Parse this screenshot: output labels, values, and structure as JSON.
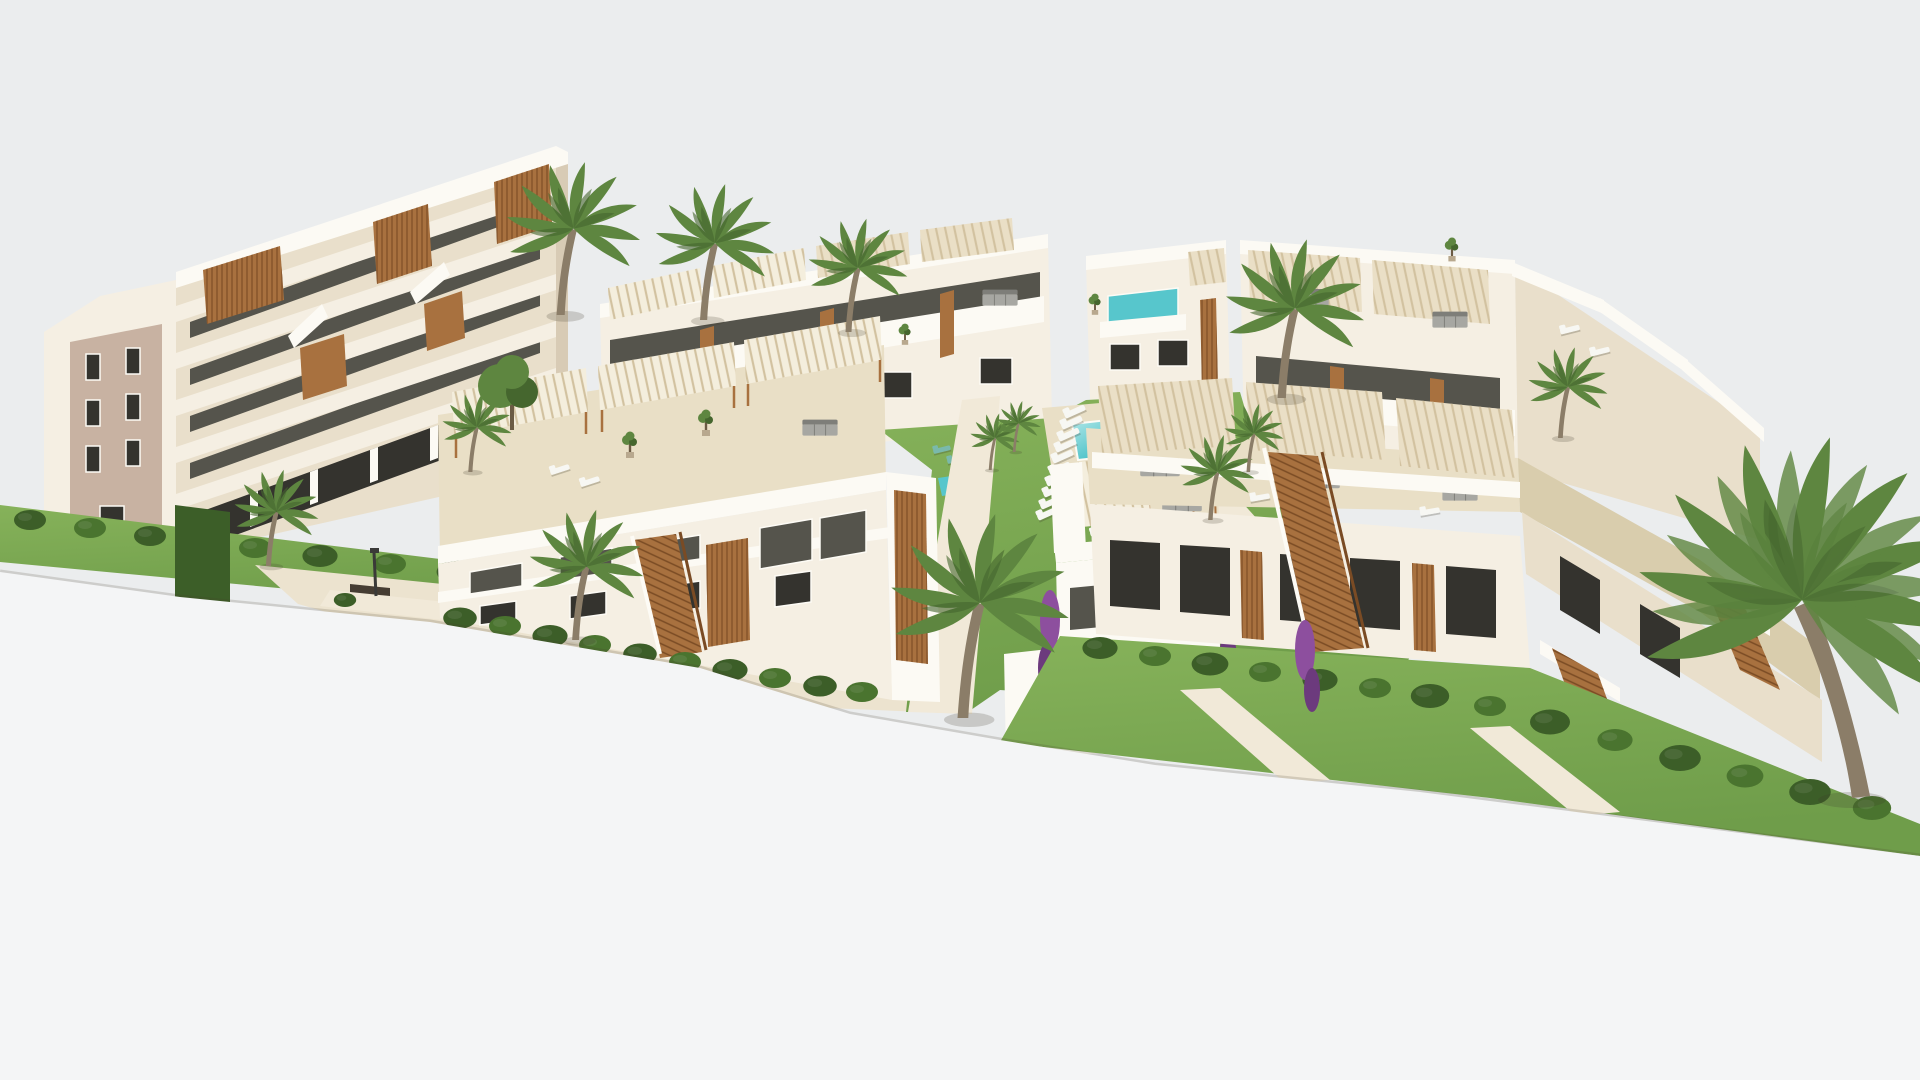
{
  "scene": {
    "title": "Aerial 3D architectural rendering of a white Mediterranean residential complex with a communal pool, lawned gardens and palm trees on a pale grey backdrop",
    "labels": {
      "sky": "pale grey backdrop",
      "foreground": "white foreground ground plane",
      "building_left": "stepped apartment building with terraces and wood accents",
      "block_back_center": "rear townhouse row with rooftop pergolas",
      "villa_center": "central villa with glass balcony",
      "block_back_right": "right rear townhouse row with roof terraces",
      "block_front_left": "front townhouse row with slatted roof pergolas",
      "villa_front": "front white villa with furnished roof terrace",
      "block_front_right": "right front townhouse block with wooden staircases",
      "pool": "communal turquoise swimming pool",
      "loungers": "rows of sun loungers",
      "garden": "lawned courtyard garden",
      "walkway": "paved walkway with benches and lampposts",
      "palms": "palm trees",
      "hedges": "clipped hedge rows",
      "stairs": "wooden exterior staircases"
    }
  },
  "palette": {
    "sky": "#ebedee",
    "fg": "#f4f5f6",
    "wallLit": "#f5efe3",
    "wallBright": "#fcfaf4",
    "wallCream": "#e9dfcb",
    "wallShadow": "#d8cbb5",
    "wallTan": "#c8b2a2",
    "glass": "#55544c",
    "glassDark": "#34332e",
    "frameWhite": "#fdfbf5",
    "pergola": "#eadfc6",
    "pergolaWhite": "#f4eedd",
    "pergolaLine": "#d2c2a0",
    "wood": "#a8713f",
    "woodDark": "#7a4b24",
    "deck": "#e9dfc6",
    "deckShadow": "#d9cdad",
    "pathBeige": "#ece3cf",
    "pathLight": "#f1e9d8",
    "grass": "#6f9d4a",
    "grassLight": "#86b25a",
    "grassDark": "#4a742f",
    "hedge": "#3c5e28",
    "pool": "#57c6cc",
    "poolLight": "#b8e9e9",
    "poolDark": "#2aa2ac",
    "trunk": "#8b7d68",
    "frond": "#5e8640",
    "frondDark": "#45662e",
    "gray": "#a7a7a2",
    "grayDark": "#7e7e79",
    "purple": "#8d4f9e",
    "purpleDark": "#6c3a7d",
    "white": "#f7f7f3",
    "benchDark": "#463d33",
    "stripe": "#7ab9ab",
    "shadowTint": "rgba(70,62,45,0.18)"
  }
}
